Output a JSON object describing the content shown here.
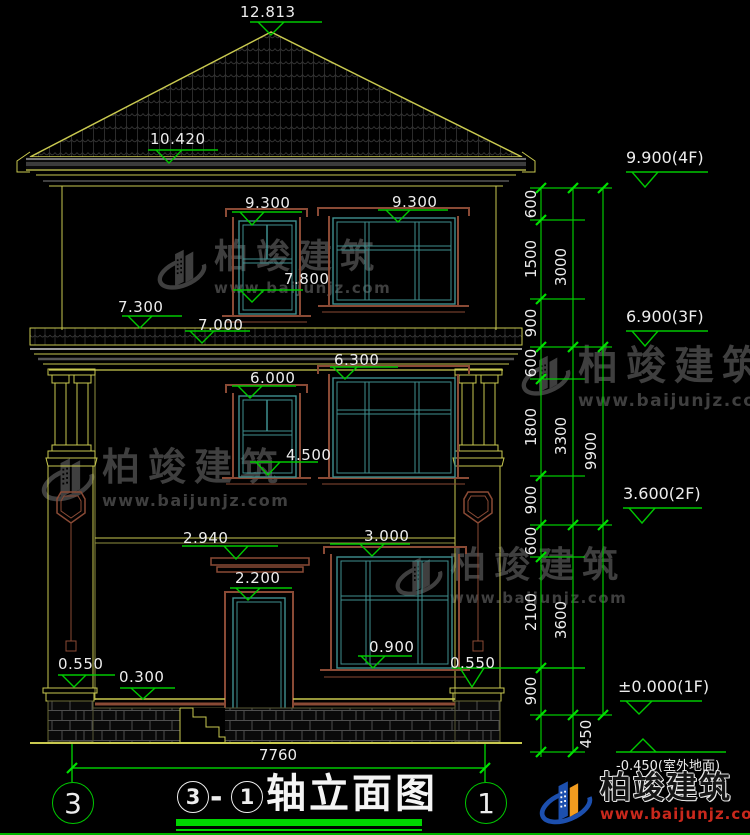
{
  "palette": {
    "background": "#000000",
    "line_yellow": "#c9c94f",
    "line_teal": "#3f9090",
    "line_brown": "#8a4a35",
    "dim_green": "#00c800",
    "tick_green": "#00e000",
    "text_white": "#ededed",
    "watermark_gray": "#3f3f3f",
    "brand_blue": "#1c4fae",
    "brand_orange": "#f29c1f",
    "brand_red": "#c8281c"
  },
  "spot_labels": [
    "12.813",
    "10.420",
    "9.300",
    "9.300",
    "7.800",
    "7.300",
    "7.000",
    "6.300",
    "6.000",
    "4.500",
    "2.940",
    "3.000",
    "2.200",
    "0.900",
    "0.550",
    "0.300",
    "0.550"
  ],
  "floor_markers": {
    "f4": "9.900(4F)",
    "f3": "6.900(3F)",
    "f2": "3.600(2F)",
    "f1": "±0.000(1F)",
    "ground": "-0.450(室外地面)"
  },
  "chain": {
    "segments": [
      "600",
      "1500",
      "900",
      "600",
      "1800",
      "900",
      "600",
      "2100",
      "900",
      "450"
    ],
    "floors": [
      "3000",
      "3300",
      "3600"
    ],
    "total": "9900",
    "width": "7760"
  },
  "axes": {
    "left": "3",
    "right": "1"
  },
  "title": {
    "axis_a": "3",
    "axis_b": "1",
    "dash": "-",
    "text": "轴立面图"
  },
  "watermark": {
    "name": "柏竣建筑",
    "url": "www.baijunjz.com"
  },
  "brand": {
    "name": "柏竣建筑",
    "url": "www.baijunjz.com"
  }
}
